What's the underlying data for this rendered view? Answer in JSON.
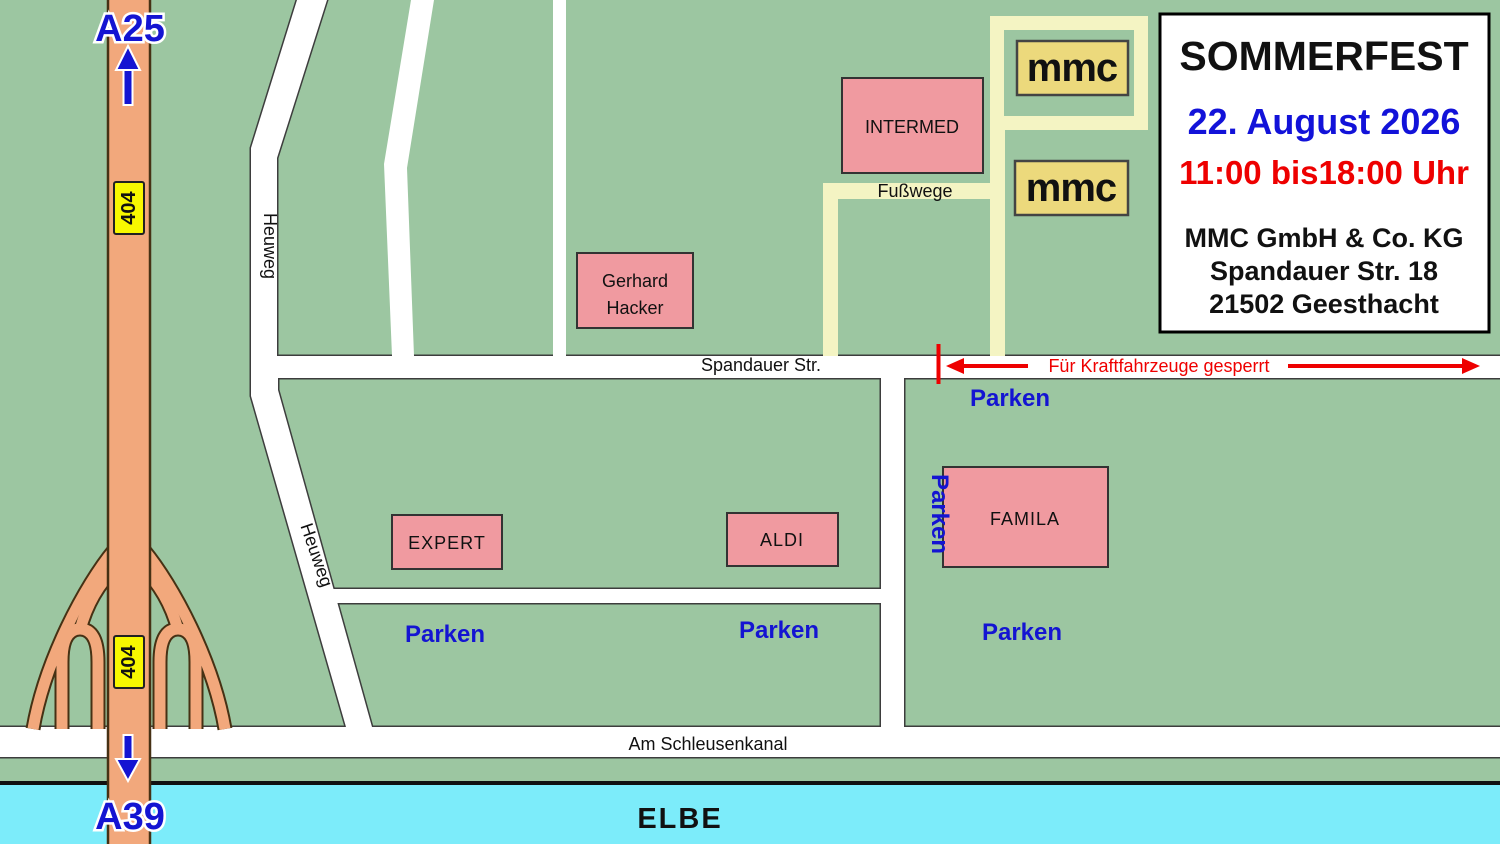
{
  "title_box": {
    "title": "SOMMERFEST",
    "date": "22. August 2026",
    "time": "11:00 bis18:00 Uhr",
    "company": "MMC GmbH & Co. KG",
    "street": "Spandauer Str. 18",
    "city": "21502 Geesthacht"
  },
  "highways": {
    "north_label": "A25",
    "south_label": "A39",
    "route_badge_top": "404",
    "route_badge_bottom": "404"
  },
  "streets": {
    "spandauer": "Spandauer Str.",
    "heuweg_upper": "Heuweg",
    "heuweg_lower": "Heuweg",
    "fusswege": "Fußwege",
    "schleusenkanal": "Am Schleusenkanal",
    "river": "ELBE"
  },
  "buildings": {
    "intermed": "INTERMED",
    "gerhard_hacker": [
      "Gerhard",
      "Hacker"
    ],
    "expert": "EXPERT",
    "aldi": "ALDI",
    "famila": "FAMILA",
    "mmc_logo_1": "mmc",
    "mmc_logo_2": "mmc"
  },
  "parking": {
    "mid_left": "Parken",
    "mid_right": "Parken",
    "right_top": "Parken",
    "right_side": "Parken",
    "right_bottom": "Parken"
  },
  "closure": {
    "text": "Für Kraftfahrzeuge gesperrt"
  },
  "colors": {
    "map_green": "#9cc6a1",
    "road_white": "#ffffff",
    "road_outline": "#3d3d3d",
    "highway_orange": "#f2a87c",
    "highway_outline": "#463114",
    "river_cyan": "#7cecfa",
    "building_pink": "#f09aa0",
    "footpath_yellow": "#f4f4c3",
    "logo_gold": "#ecd97c",
    "badge_yellow": "#f8f800",
    "label_blue": "#1414d2",
    "alert_red": "#ee0000"
  }
}
